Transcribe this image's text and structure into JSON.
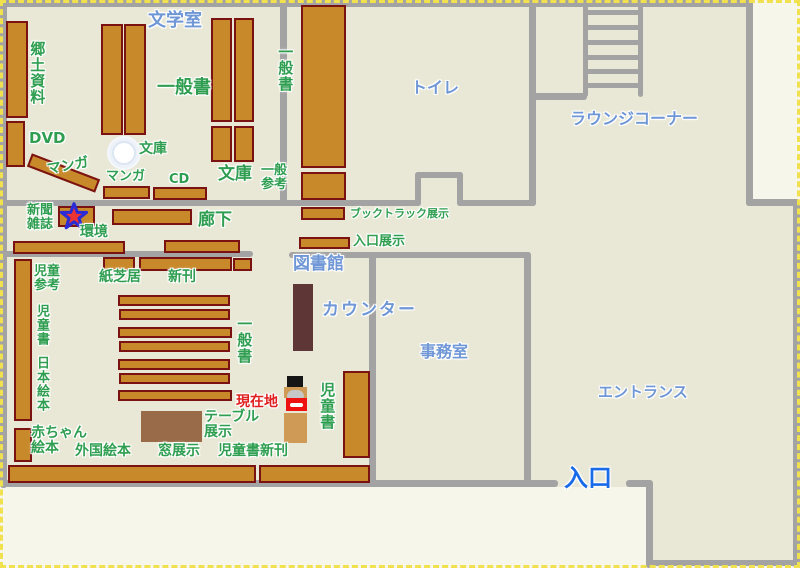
{
  "colors": {
    "wall": "#a3a3a3",
    "floor": "#e9e8d6",
    "paper": "#f7f6ea",
    "shelf": "#c8892b",
    "shelf_border": "#7b1212",
    "counter": "#5e3636",
    "table": "#9a6b49",
    "marker_tan": "#cf9a55",
    "marker_red": "#ee1111",
    "label_green": "#2f9e50",
    "label_blue": "#6f97d6",
    "entrance_blue": "#1a6be8",
    "current_red": "#e02020",
    "star_fill": "#ee3333",
    "star_stroke": "#2b2bd6"
  },
  "rooms": {
    "literature_room": "文学室",
    "toilet": "トイレ",
    "lounge_corner": "ラウンジコーナー",
    "library": "図書館",
    "counter": "カウンター",
    "office": "事務室",
    "entrance_hall": "エントランス",
    "entrance": "入口"
  },
  "areas": {
    "local_materials": "郷土資料",
    "dvd": "DVD",
    "manga_top": "マンガ",
    "manga_mid": "マンガ",
    "cd": "CD",
    "bunko_round": "文庫",
    "bunko_right": "文庫",
    "general_books_top": "一般書",
    "general_books_right": "一般書",
    "general_books_center": "一般書",
    "general_reference": "一般\n参考",
    "newspaper_magazines": "新聞\n雑誌",
    "environment": "環境",
    "corridor": "廊下",
    "booktruck_display": "ブックトラック展示",
    "entrance_display": "入口展示",
    "children_reference": "児童\n参考",
    "kamishibai": "紙芝居",
    "new_books": "新刊",
    "children_books_left": "児童書",
    "japanese_picture_books": "日本絵本",
    "baby_picture_books": "赤ちゃん\n絵本",
    "foreign_picture_books": "外国絵本",
    "window_display": "窓展示",
    "children_new_books": "児童書新刊",
    "table_display": "テーブル\n展示",
    "children_books_right": "児童書",
    "current_location": "現在地"
  }
}
